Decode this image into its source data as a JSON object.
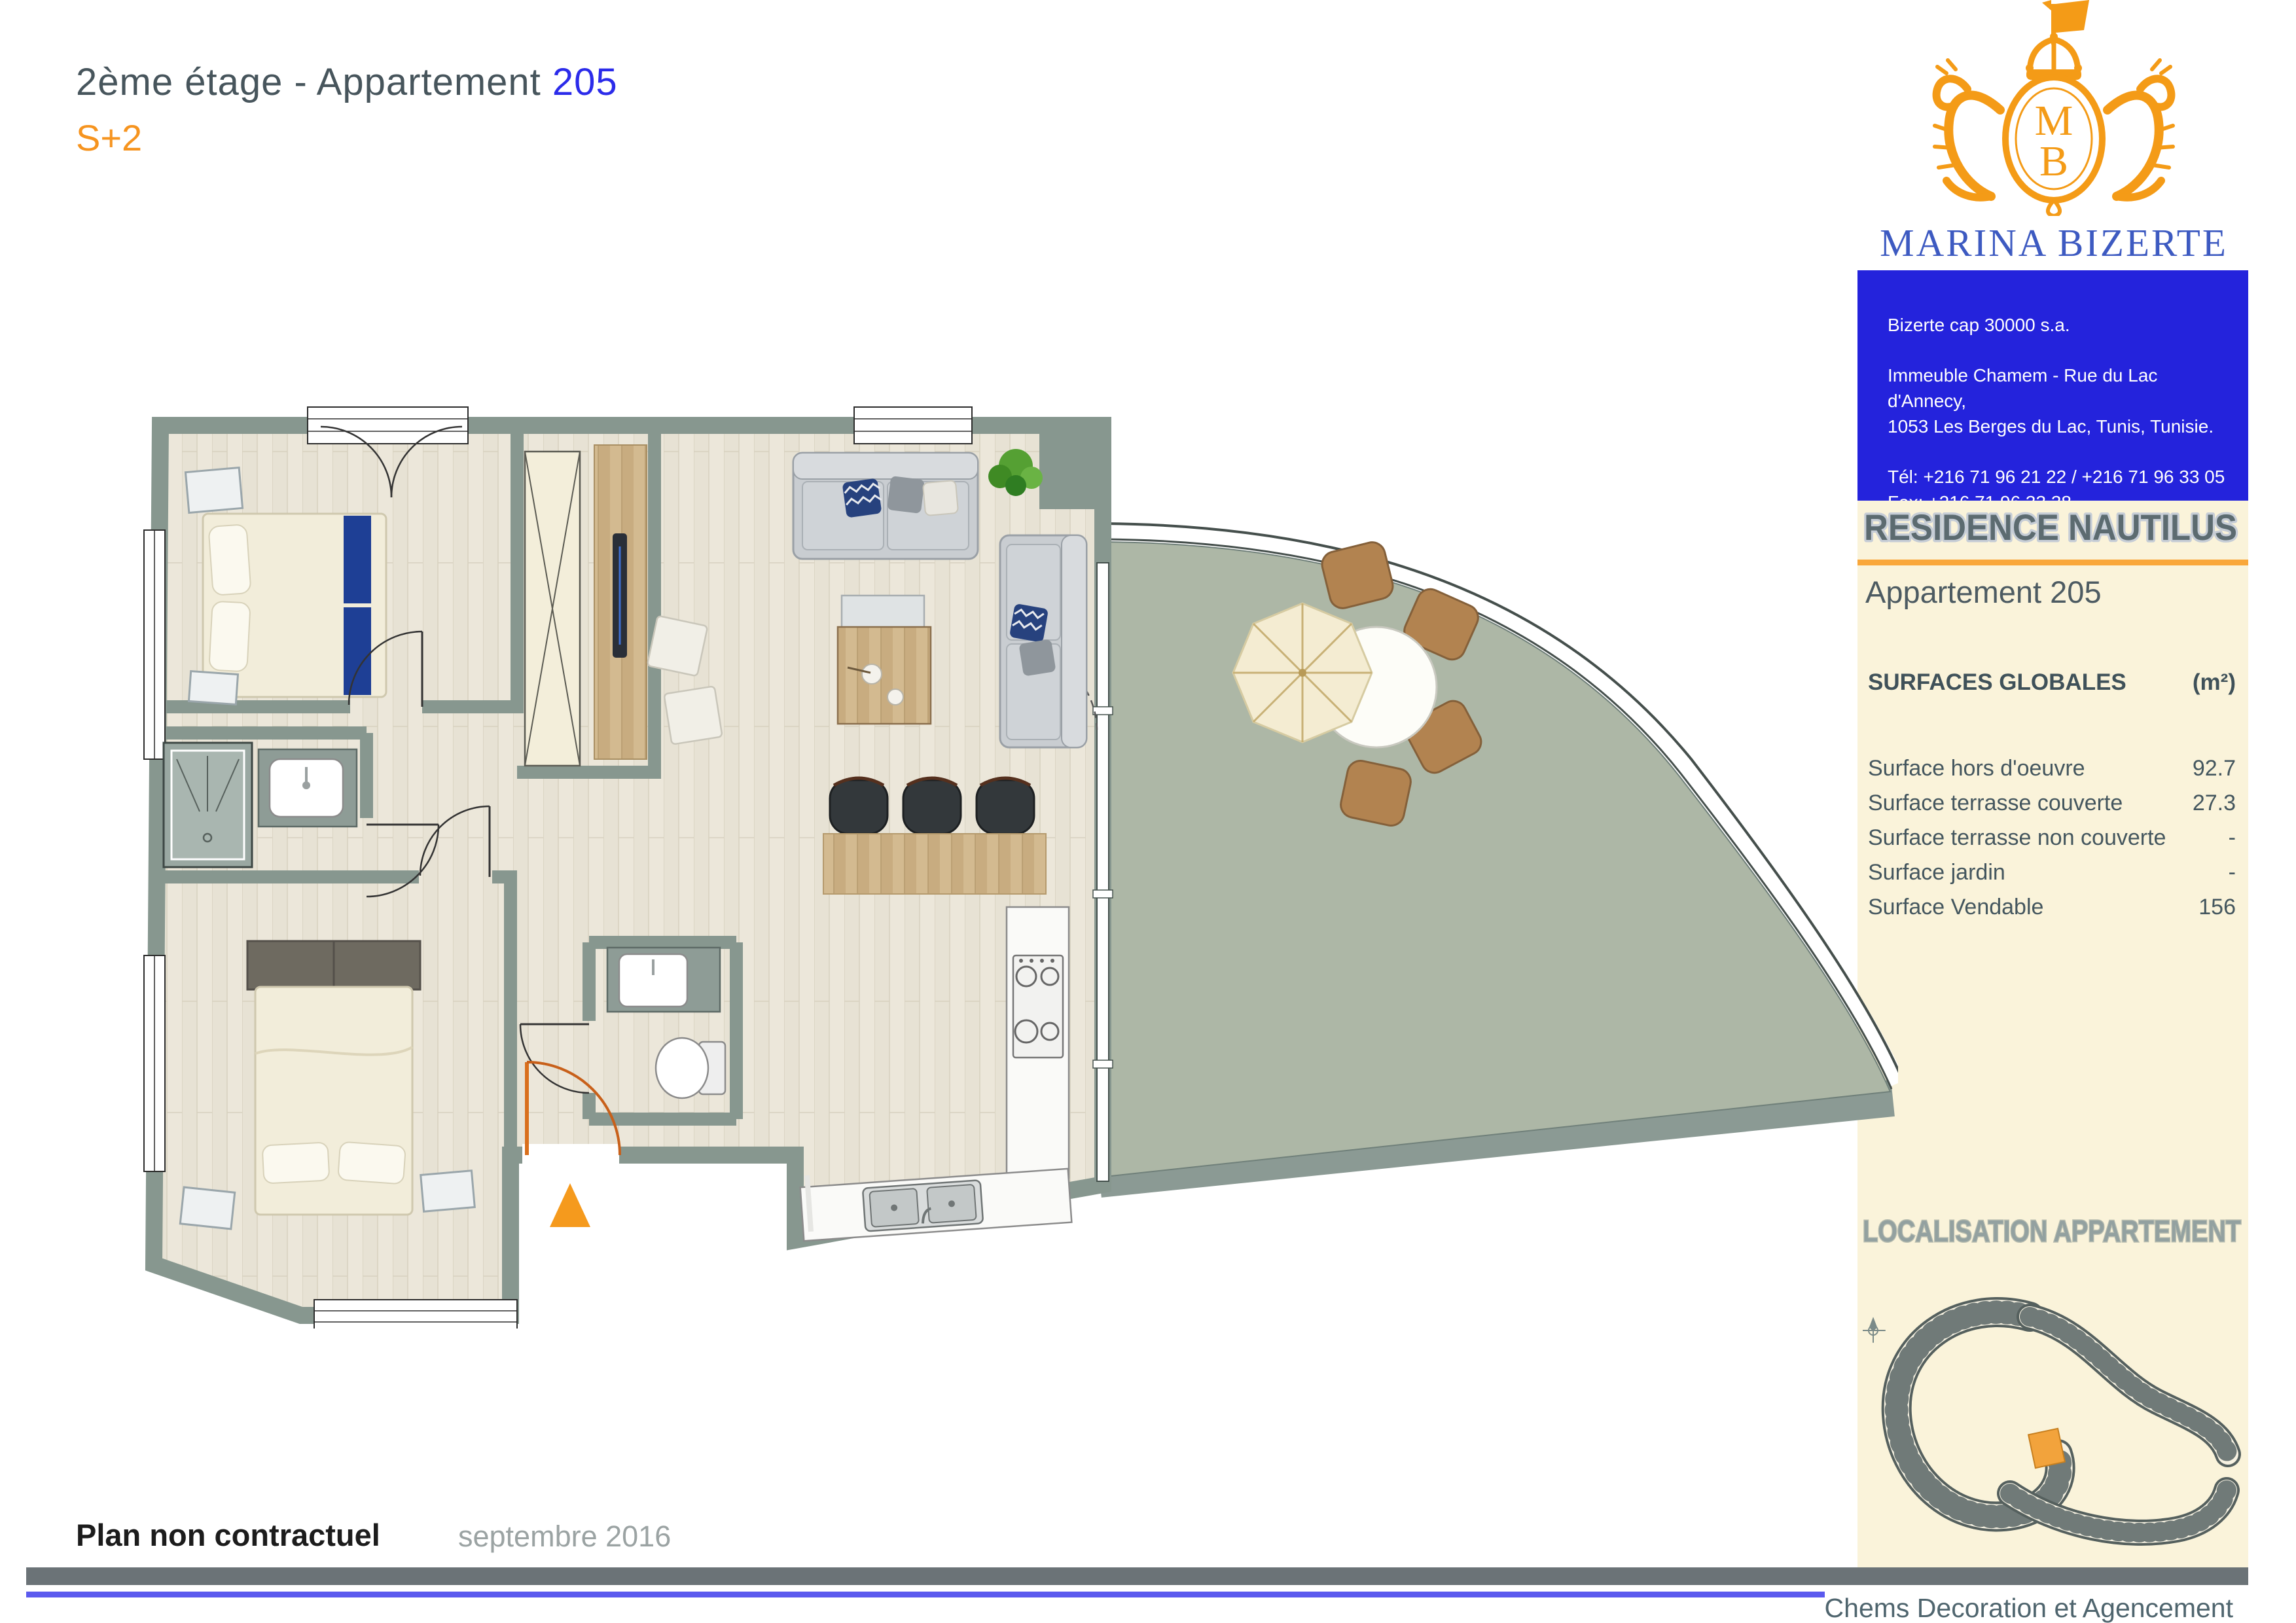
{
  "page": {
    "title_prefix": "2ème étage - Appartement ",
    "title_number": "205",
    "subtitle": "S+2",
    "footer_left": "Plan non contractuel",
    "footer_date": "septembre 2016",
    "footer_credit": "Chems Decoration et Agencement"
  },
  "brand": {
    "name": "MARINA BIZERTE",
    "country": "TUNISIA",
    "monogram_top": "M",
    "monogram_bottom": "B"
  },
  "contact": {
    "company": "Bizerte cap 30000 s.a.",
    "address_line1": "Immeuble Chamem - Rue du Lac d'Annecy,",
    "address_line2": "1053 Les Berges du Lac, Tunis, Tunisie.",
    "tel": "Tél: +216 71 96 21 22 / +216 71 96 33 05",
    "fax": "Fax: +216 71 96 33 38",
    "website": "www.marinabizerte.com"
  },
  "panel": {
    "residence": "RESIDENCE NAUTILUS",
    "apartment": "Appartement 205",
    "surfaces": {
      "header_label": "SURFACES GLOBALES",
      "header_unit": "(m²)",
      "rows": [
        {
          "label": "Surface hors d'oeuvre",
          "value": "92.7"
        },
        {
          "label": "Surface terrasse couverte",
          "value": "27.3"
        },
        {
          "label": "Surface terrasse non couverte",
          "value": "-"
        },
        {
          "label": "Surface jardin",
          "value": "-"
        },
        {
          "label": "Surface Vendable",
          "value": "156"
        }
      ]
    },
    "localisation_title": "LOCALISATION APPARTEMENT"
  },
  "colors": {
    "title_gray": "#47555c",
    "title_blue": "#2b2bea",
    "accent_orange": "#f6941f",
    "brand_blue": "#3d5ac1",
    "contact_box_blue": "#2423dc",
    "panel_cream": "#faf3da",
    "panel_rule_orange": "#f9a73b",
    "wall_gray": "#87978f",
    "terrace_green": "#adb7a6",
    "floor_wood": "#e8e3d6",
    "highlight_unit_orange": "#f2a33c",
    "footer_bar_gray": "#6b7377",
    "footer_line_blue": "#5b5aee"
  }
}
